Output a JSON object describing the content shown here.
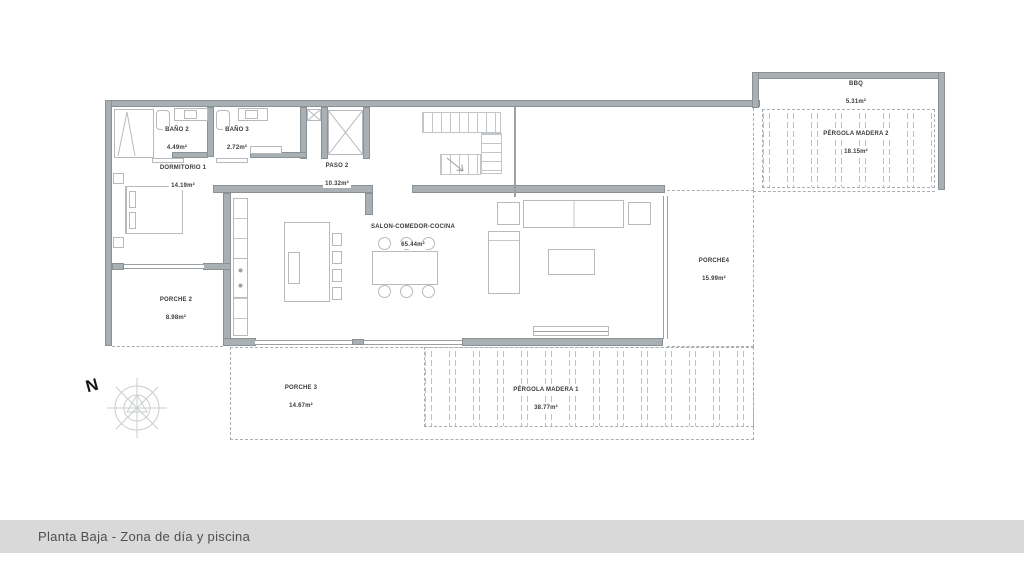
{
  "title_bar": {
    "text": "Planta Baja - Zona de día y piscina",
    "bg_color": "#d9d9d9",
    "text_color": "#4f4f4f"
  },
  "compass": {
    "north_label": "N"
  },
  "colors": {
    "wall_fill": "#a9b0b3",
    "wall_edge": "#8b9295",
    "furniture_line": "#b6babc",
    "dashed_line": "#a8aeb1",
    "label_text": "#3b3b3b"
  },
  "rooms": {
    "bano2": {
      "name": "BAÑO 2",
      "area": "4.49m²"
    },
    "bano3": {
      "name": "BAÑO 3",
      "area": "2.72m²"
    },
    "dormitorio1": {
      "name": "DORMITORIO 1",
      "area": "14.19m²"
    },
    "paso2": {
      "name": "PASO 2",
      "area": "10.32m²"
    },
    "salon": {
      "name": "SALON-COMEDOR-COCINA",
      "area": "65.44m²"
    },
    "porche2": {
      "name": "PORCHE 2",
      "area": "8.98m²"
    },
    "porche3": {
      "name": "PORCHE 3",
      "area": "14.67m²"
    },
    "porche4": {
      "name": "PORCHE4",
      "area": "15.99m²"
    },
    "pergola_madera1": {
      "name": "PÉRGOLA MADERA 1",
      "area": "38.77m²"
    },
    "pergola_madera2": {
      "name": "PÉRGOLA MADERA 2",
      "area": "18.15m²"
    },
    "bbq": {
      "name": "BBQ",
      "area": "5.31m²"
    }
  }
}
